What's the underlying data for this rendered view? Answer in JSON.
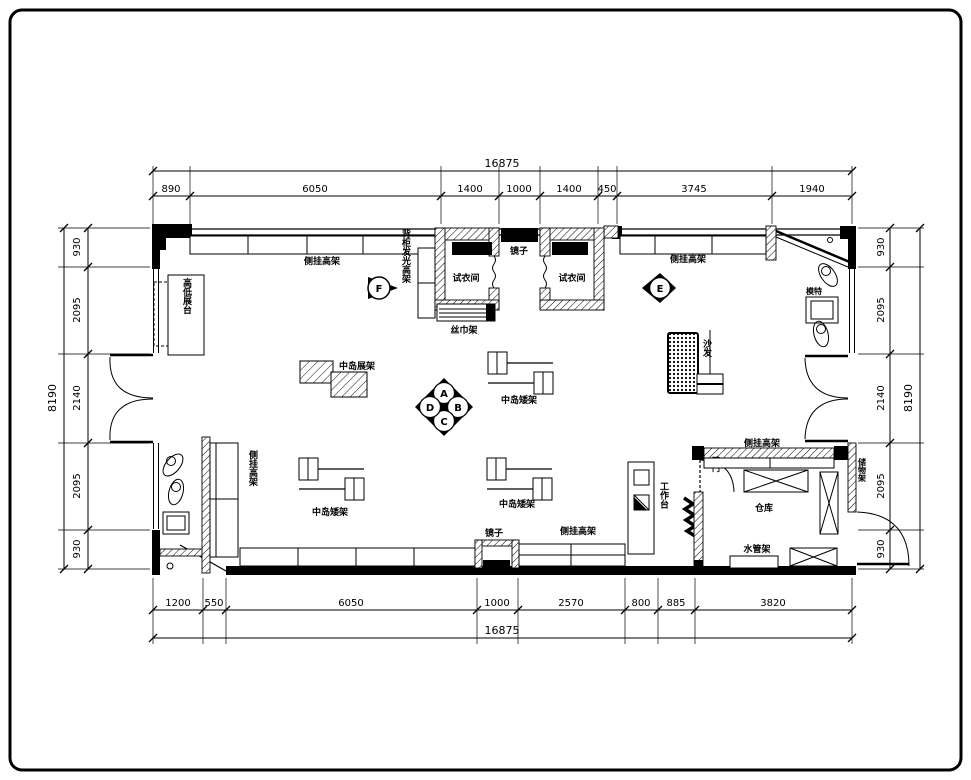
{
  "drawing_title": "retail store fixture floor plan",
  "colors": {
    "line": "#000000",
    "background": "#ffffff"
  },
  "dimensions": {
    "top": {
      "total": "16875",
      "segments": [
        "890",
        "6050",
        "1400",
        "1000",
        "1400",
        "450",
        "3745",
        "1940"
      ]
    },
    "bottom": {
      "total": "16875",
      "segments": [
        "1200",
        "550",
        "6050",
        "1000",
        "2570",
        "800",
        "885",
        "3820"
      ]
    },
    "left": {
      "total": "8190",
      "segments": [
        "930",
        "2095",
        "2140",
        "2095",
        "930"
      ]
    },
    "right": {
      "total": "8190",
      "segments": [
        "930",
        "2095",
        "2140",
        "2095",
        "930"
      ]
    }
  },
  "labels": {
    "side_hang_rack": "侧挂高架",
    "backlit_back_rack": "背柜发光高架",
    "fitting_room": "试衣间",
    "mirror": "镜子",
    "scarf_rack": "丝巾架",
    "high_low_platform": "高低展台",
    "island_display_rack": "中岛展架",
    "island_low_rack": "中岛矮架",
    "sofa": "沙发",
    "mannequin": "模特",
    "workbench": "工作台",
    "warehouse": "仓库",
    "water_pipe_rack": "水管架",
    "hidden_door": "暗门",
    "storage_rack": "储物架"
  },
  "elevation_markers": {
    "a": "A",
    "b": "B",
    "c": "C",
    "d": "D",
    "e": "E",
    "f": "F"
  }
}
